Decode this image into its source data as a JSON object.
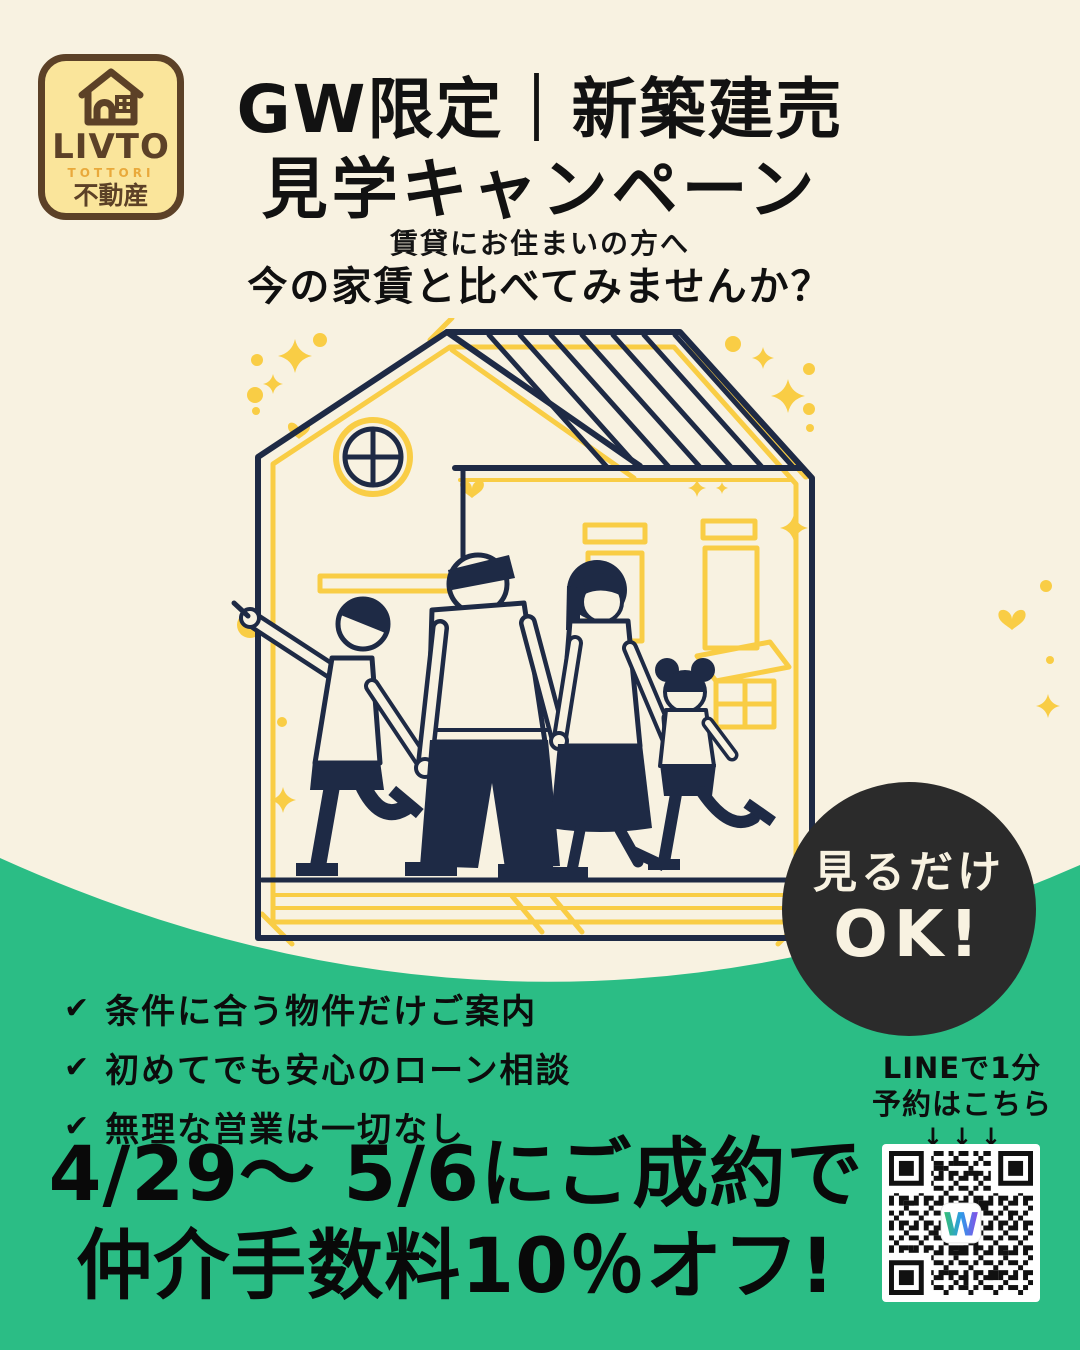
{
  "colors": {
    "background_cream": "#F8F2E1",
    "green": "#2BBD85",
    "illustration_navy": "#1E2A45",
    "illustration_yellow": "#F9CD45",
    "badge_black": "#2B2B2B",
    "badge_text_cream": "#F8F2E1",
    "logo_background": "#FAE59B",
    "logo_brown": "#5C4127",
    "logo_orange": "#E9A93B",
    "qr_logo_gradient": [
      "#35C26B",
      "#2E9BE8",
      "#8A4BE8"
    ]
  },
  "logo": {
    "icon": "house-icon",
    "brand": "LIVTO",
    "region": "TOTTORI",
    "category": "不動産"
  },
  "header": {
    "title_line1": "GW限定｜新築建売",
    "title_line2": "見学キャンペーン",
    "lead": "賃貸にお住まいの方へ",
    "question": "今の家賃と比べてみませんか？"
  },
  "ok_badge": {
    "line1": "見るだけ",
    "line2": "OK!"
  },
  "benefits": {
    "check_icon": "✔",
    "items": [
      {
        "label": "条件に合う物件だけご案内"
      },
      {
        "label": "初めてでも安心のローン相談"
      },
      {
        "label": "無理な営業は一切なし"
      }
    ]
  },
  "offer": {
    "line1": "4/29〜 5/6にご成約で",
    "line2": "仲介手数料10％オフ!"
  },
  "line_cta": {
    "title": "LINEで1分",
    "subtitle": "予約はこちら",
    "arrows": "↓↓↓",
    "qr_center_logo": "W"
  }
}
